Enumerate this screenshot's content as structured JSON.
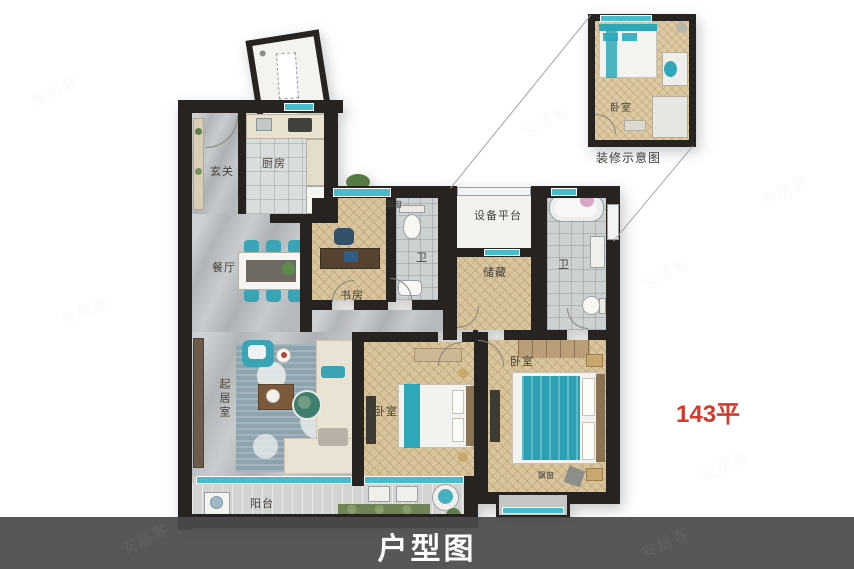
{
  "page_title": "户型图",
  "area_label": "143平",
  "inset_caption": "装修示意图",
  "watermark_text": "安居客",
  "rooms": {
    "entrance": "玄关",
    "kitchen": "厨房",
    "dining": "餐厅",
    "study": "书房",
    "bath": "卫",
    "equipment_platform": "设备平台",
    "storage": "储藏",
    "bedroom": "卧室",
    "living_room": "起居室",
    "balcony": "阳台",
    "bay_window": "飘窗"
  },
  "colors": {
    "wall": "#262320",
    "wood_floor": "#d8c59c",
    "marble_floor": "#bcbfc1",
    "accent_teal": "#2ea7b8",
    "area_label_red": "#d6382c",
    "footer_band": "#4a4a4a",
    "title_text": "#fbfbfb"
  }
}
